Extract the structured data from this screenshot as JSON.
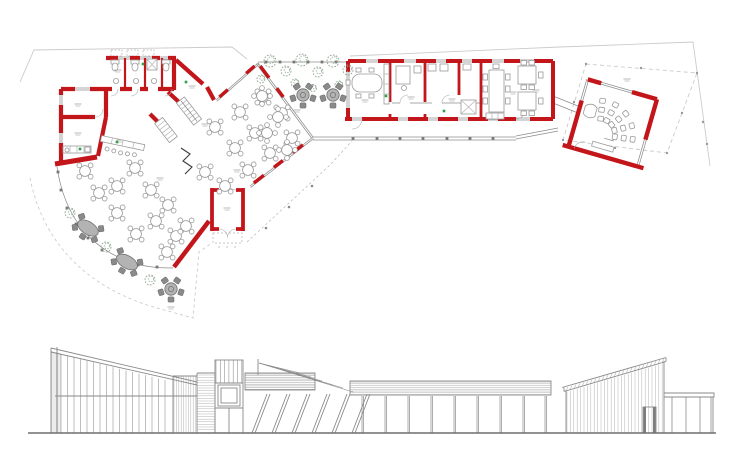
{
  "meta": {
    "drawing_type": "architectural-plan-and-elevation",
    "views": [
      "floor-plan",
      "front-elevation"
    ]
  },
  "palette": {
    "paper": "#ffffff",
    "wall_red": "#c3161b",
    "line_medium": "#8c8c8c",
    "line_light": "#b5b5b5",
    "faint": "#cbcbcb",
    "furniture": "#9a9a9a",
    "outdoor_fill": "#b3b3b3",
    "outdoor_dark": "#8a8a8a",
    "tree": "#8fa78f",
    "accent_green": "#2f9e44",
    "elevation_line": "#8a8a8a",
    "hatch": "#a8a8a8"
  },
  "plan": {
    "dining_tables": [
      [
        85,
        171
      ],
      [
        99,
        193
      ],
      [
        117,
        186
      ],
      [
        135,
        168
      ],
      [
        151,
        190
      ],
      [
        168,
        205
      ],
      [
        117,
        213
      ],
      [
        136,
        234
      ],
      [
        156,
        221
      ],
      [
        176,
        236
      ],
      [
        167,
        252
      ],
      [
        186,
        226
      ],
      [
        240,
        112
      ],
      [
        263,
        97
      ],
      [
        282,
        113
      ],
      [
        255,
        133
      ],
      [
        292,
        138
      ],
      [
        235,
        148
      ],
      [
        270,
        153
      ],
      [
        248,
        170
      ],
      [
        215,
        127
      ],
      [
        225,
        186
      ],
      [
        205,
        172
      ]
    ],
    "garden_white_tables": [
      [
        262,
        96
      ],
      [
        278,
        117
      ],
      [
        267,
        133
      ],
      [
        287,
        150
      ]
    ],
    "garden_flower_tables": [
      [
        303,
        95
      ],
      [
        333,
        95
      ]
    ],
    "terrace_oval_tables": [
      [
        88,
        228,
        32
      ],
      [
        127,
        262,
        30
      ]
    ],
    "terrace_flower_tables": [
      [
        171,
        289
      ]
    ],
    "trees": [
      [
        270,
        61,
        6
      ],
      [
        286,
        71,
        5
      ],
      [
        302,
        60,
        6
      ],
      [
        318,
        72,
        5
      ],
      [
        333,
        61,
        6
      ],
      [
        348,
        70,
        5
      ],
      [
        261,
        79,
        4
      ],
      [
        295,
        83,
        4
      ],
      [
        339,
        85,
        4
      ],
      [
        313,
        88,
        3.5
      ],
      [
        70,
        213,
        5
      ],
      [
        106,
        247,
        5
      ],
      [
        150,
        280,
        5
      ]
    ],
    "curve_columns": [
      [
        58,
        172
      ],
      [
        61,
        190
      ],
      [
        67,
        208
      ],
      [
        76,
        224
      ],
      [
        88,
        238
      ],
      [
        102,
        250
      ],
      [
        119,
        259
      ],
      [
        138,
        265
      ],
      [
        157,
        267
      ]
    ],
    "walkway_ticks_x": [
      353,
      377,
      400,
      423,
      447,
      470,
      493
    ],
    "walkway_ticks_y": 138.5,
    "garden_ticks_x": [
      266,
      280,
      294,
      308,
      322,
      336
    ],
    "garden_ticks_y": 62,
    "canopy_dots": [
      [
        266,
        228
      ],
      [
        289,
        207
      ],
      [
        312,
        186
      ]
    ],
    "pavilion_roof_dots": [
      [
        586,
        64
      ],
      [
        697,
        73
      ],
      [
        667,
        153
      ],
      [
        563,
        140
      ],
      [
        641,
        68
      ],
      [
        682,
        113
      ],
      [
        615,
        148
      ],
      [
        574,
        102
      ],
      [
        703,
        122
      ],
      [
        707,
        144
      ]
    ],
    "micro_labels": [
      [
        78,
        104
      ],
      [
        78,
        133
      ],
      [
        118,
        70
      ],
      [
        192,
        86
      ],
      [
        205,
        124
      ],
      [
        160,
        178
      ],
      [
        237,
        170
      ],
      [
        227,
        208
      ],
      [
        297,
        110
      ],
      [
        365,
        100
      ],
      [
        411,
        97
      ],
      [
        452,
        99
      ],
      [
        513,
        92
      ],
      [
        536,
        90
      ],
      [
        627,
        79
      ],
      [
        171,
        307
      ],
      [
        120,
        140
      ]
    ],
    "green_accents": [
      [
        143,
        64
      ],
      [
        186,
        82
      ],
      [
        117,
        142
      ],
      [
        386,
        96
      ],
      [
        444,
        111
      ],
      [
        80,
        149
      ]
    ]
  },
  "pavilion": {
    "cx": 613,
    "cy": 122,
    "rotation_deg": 16,
    "chair_radii": [
      16,
      25,
      34
    ],
    "chair_angles_deg": [
      -100,
      -77,
      -54,
      -31,
      -8
    ],
    "focus": [
      -10,
      16
    ]
  },
  "elevation": {
    "ground_y": 433,
    "ground_x1": 28,
    "ground_x2": 716,
    "glazing": {
      "x1": 61,
      "x2": 170,
      "step": 6.5
    },
    "panel": {
      "x1": 52,
      "x2": 60,
      "step": 2
    },
    "roof": {
      "x0": 52,
      "y0": 349,
      "x1": 197,
      "y1": 385
    },
    "blockA": {
      "x1": 174,
      "x2": 196,
      "step": 2.4,
      "top": 376,
      "bottom": 432
    },
    "blockB": {
      "y1": 375,
      "y2": 432,
      "step": 2.6,
      "x1": 197,
      "x2": 215
    },
    "tower": {
      "x1": 216,
      "x2": 242,
      "step": 4.3,
      "y1": 360,
      "y2": 383
    },
    "band1": {
      "x": 245,
      "x2": 315,
      "y": 373,
      "y2": 390,
      "step": 1.7
    },
    "band2": {
      "x": 350,
      "x2": 551,
      "y": 381,
      "y2": 395,
      "step": 1.8
    },
    "fan": {
      "ox": 259,
      "oy": 363,
      "ends": [
        [
          300,
          373
        ],
        [
          311,
          377
        ],
        [
          322,
          381
        ],
        [
          333,
          385
        ],
        [
          343,
          388
        ],
        [
          353,
          392
        ]
      ]
    },
    "struts_x": [
      252,
      272,
      292,
      312,
      332,
      352
    ],
    "columns_x": [
      362,
      385,
      408,
      431,
      454,
      477,
      500,
      523,
      545
    ],
    "right_building": {
      "x1": 567,
      "x2": 663,
      "step": 3.4,
      "roof_x0": 564,
      "roof_y0": 391,
      "roof_x1": 666,
      "roof_y1": 361
    },
    "pergola_posts_x": [
      672,
      686,
      700,
      711
    ]
  }
}
